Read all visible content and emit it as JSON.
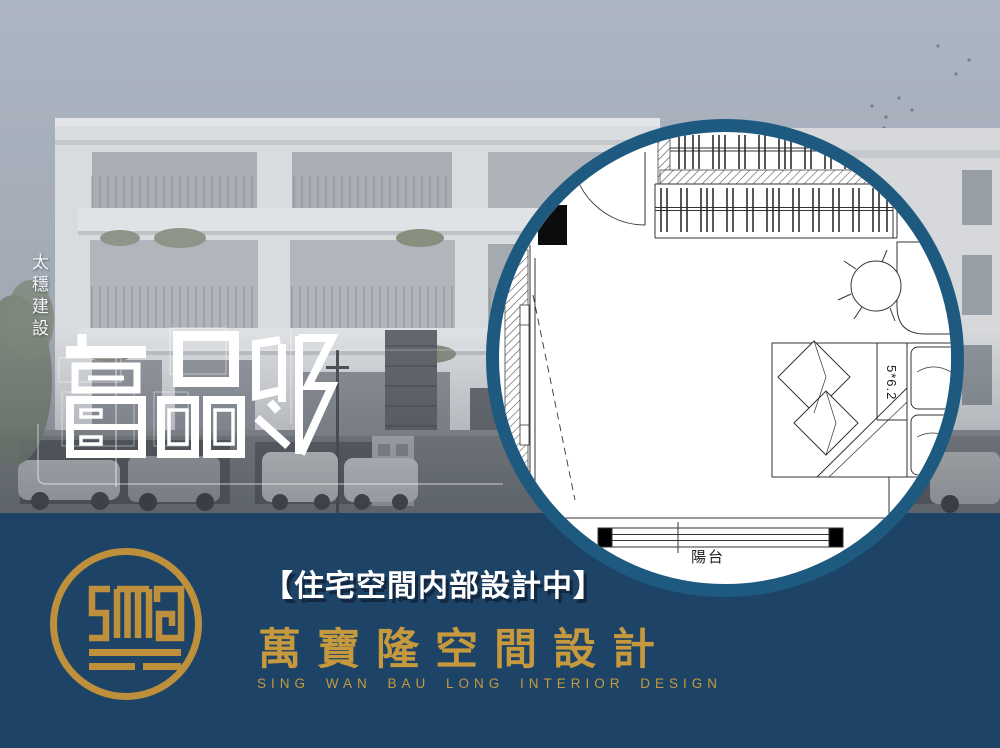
{
  "hero": {
    "developer": "太穩建設",
    "title": "富品邸"
  },
  "floorplan": {
    "balcony": "陽台",
    "bed_size": "5*6.2"
  },
  "footer": {
    "tagline": "【住宅空間内部設計中】",
    "company_zh": "萬寶隆空間設計",
    "company_en": "SING WAN BAU LONG INTERIOR DESIGN"
  },
  "icons": {
    "logo": "sing-wan-bau-long-monogram",
    "floorplan_elements": [
      "door-swing",
      "closet-hanging-rail",
      "office-chair",
      "desk",
      "double-bed",
      "pillows",
      "balcony-window",
      "tv-cabinet"
    ]
  },
  "colors": {
    "band_navy": "#1d4366",
    "ring_blue": "#1e5a80",
    "text_gold": "#c6993e",
    "logo_gold": "#bf903c",
    "sky": "#a9b2bd",
    "title_white": "#ffffff"
  }
}
